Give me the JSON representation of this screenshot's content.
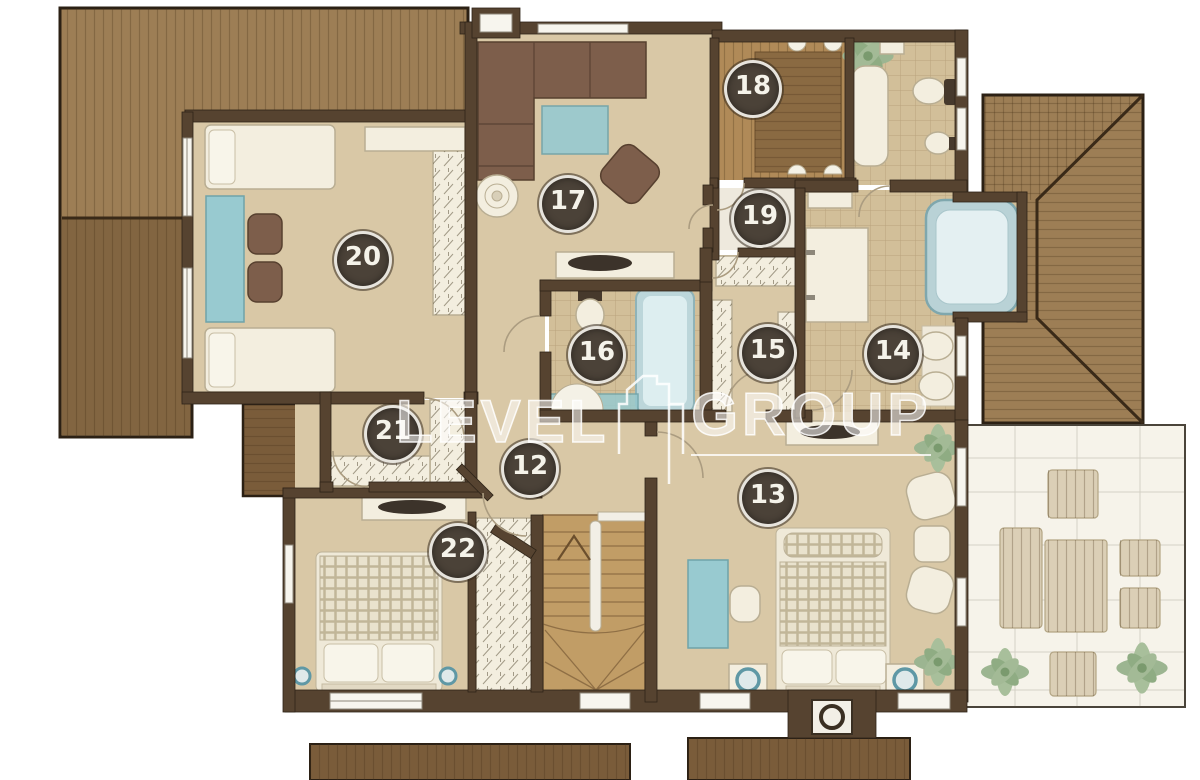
{
  "plan": {
    "watermark": {
      "left": "LEVEL",
      "right": "GROUP",
      "icon": "house-outline-icon"
    },
    "rooms": [
      {
        "id": "hallway",
        "number": "12"
      },
      {
        "id": "master-bedroom",
        "number": "13"
      },
      {
        "id": "master-bathroom",
        "number": "14"
      },
      {
        "id": "walk-in-closet",
        "number": "15"
      },
      {
        "id": "bathroom",
        "number": "16"
      },
      {
        "id": "living-room",
        "number": "17"
      },
      {
        "id": "sauna",
        "number": "18"
      },
      {
        "id": "utility-room",
        "number": "19"
      },
      {
        "id": "guest-bedroom",
        "number": "20"
      },
      {
        "id": "closet",
        "number": "21"
      },
      {
        "id": "bedroom",
        "number": "22"
      }
    ],
    "colors": {
      "wall": "#564330",
      "floor": "#d9c8a6",
      "tile": "#d2bf99",
      "roof": "#9d7e55",
      "roof_dark": "#7a5c3a",
      "stairs": "#c19d66",
      "accent_teal": "#98cad0",
      "badge_bg": "#4b4238",
      "badge_text": "#f5f3ea",
      "watermark": "#ffffff"
    }
  }
}
